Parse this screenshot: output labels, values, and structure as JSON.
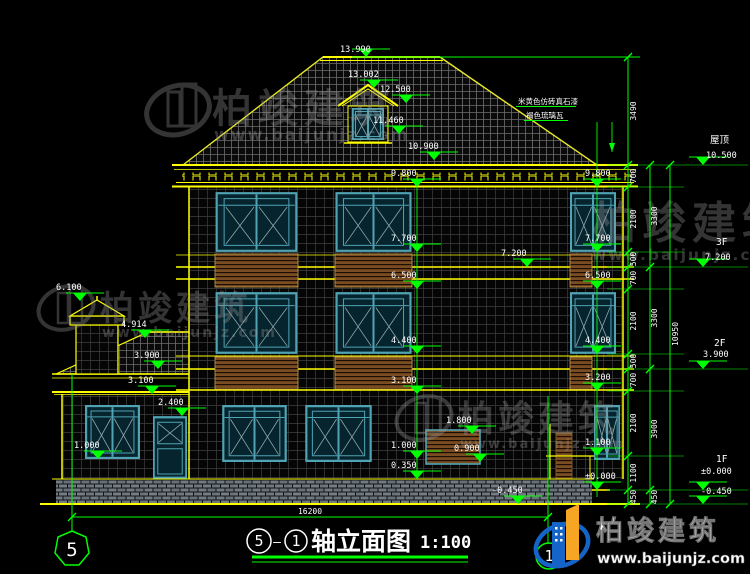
{
  "title_bar": {
    "axis_from": "5",
    "separator": "—",
    "axis_to": "1",
    "title": "轴立面图",
    "scale": "1:100"
  },
  "axis_bubbles": {
    "left": "5",
    "right": "1"
  },
  "overall_dims": {
    "width": "16200",
    "height_total": "10950"
  },
  "dim_chain_outer": [
    "3490",
    "700",
    "2100",
    "500",
    "700",
    "2100",
    "500",
    "700",
    "2100",
    "1100",
    "450"
  ],
  "dim_chain_inner": [
    "3300",
    "3300",
    "3900",
    "450"
  ],
  "floor_flags": [
    {
      "name": "屋顶",
      "elev": "10.500"
    },
    {
      "name": "3F",
      "elev": "7.200"
    },
    {
      "name": "2F",
      "elev": "3.900"
    },
    {
      "name": "1F",
      "elev": "±0.000"
    },
    {
      "name": "",
      "elev": "-0.450"
    }
  ],
  "markers": {
    "peak": "13.990",
    "dormer_ridge": "13.002",
    "dormer_eave": "12.500",
    "dormer_sill": "11.460",
    "roof_eave": "10.900",
    "left_stack": [
      "9.800",
      "7.700",
      "6.500",
      "4.400",
      "3.100",
      "1.000",
      "0.350"
    ],
    "right_stack": [
      "9.800",
      "7.700",
      "6.500",
      "4.400",
      "3.200",
      "1.100",
      "±0.000"
    ],
    "f3_slab": "7.200",
    "door_head": "1.800",
    "window_sill": "0.900",
    "ground": "-0.450",
    "porch": [
      "6.100",
      "4.914",
      "3.900",
      "3.100",
      "2.400",
      "1.000"
    ]
  },
  "notes": {
    "wall": "米黄色仿砖真石漆",
    "roof": "褐色琉璃瓦"
  },
  "watermark": {
    "brand": "柏竣建筑",
    "url": "www.baijunjz.com"
  },
  "logo": {
    "brand": "柏竣建筑",
    "url": "www.baijunjz.com"
  },
  "colors": {
    "dim_green": "#00ff00",
    "outline_yellow": "#ffff00",
    "window_teal": "#4fa3b3",
    "slat_brown": "#7a4c22",
    "logo_blue": "#1565c8",
    "logo_orange": "#f6a623"
  }
}
